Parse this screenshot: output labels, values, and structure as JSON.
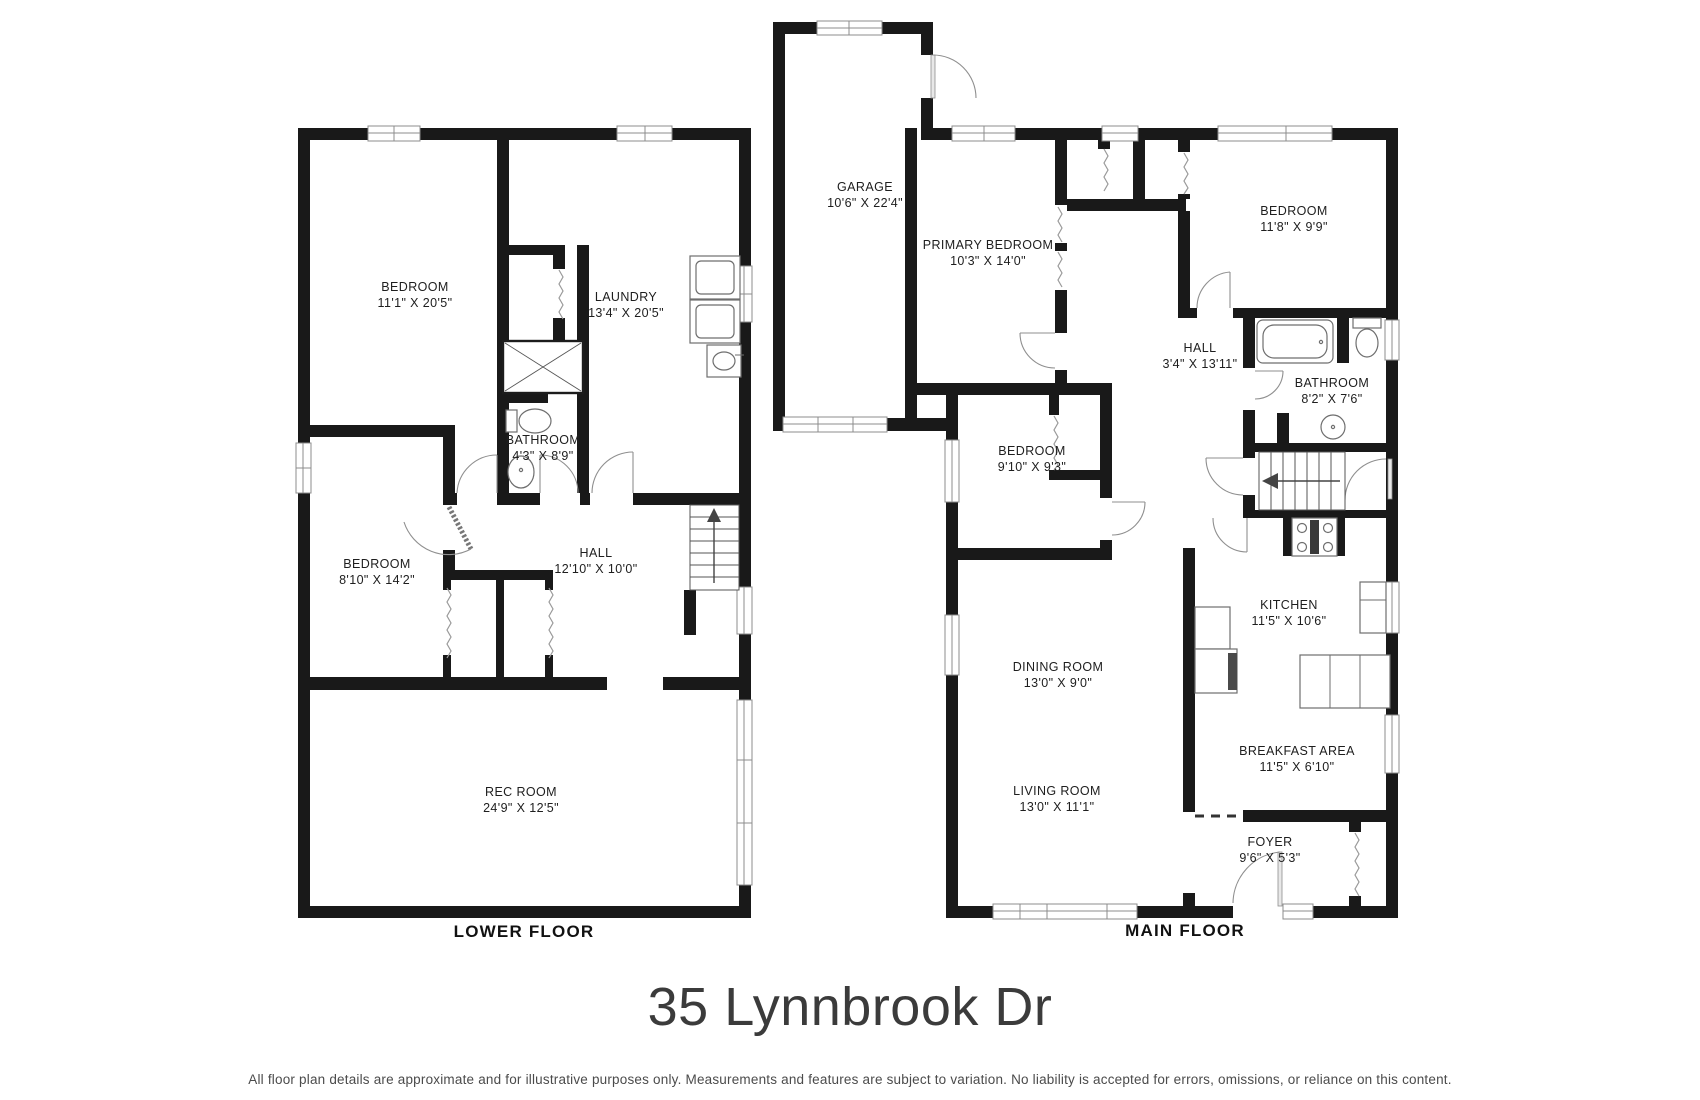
{
  "title": "35 Lynnbrook Dr",
  "disclaimer": "All floor plan details are approximate and for illustrative purposes only. Measurements and features are subject to variation. No liability is accepted for errors, omissions, or reliance on this content.",
  "colors": {
    "wall": "#191919",
    "text": "#1e1e1e",
    "title": "#3b3b3b",
    "line_gray": "#8f8f8f"
  },
  "floors": {
    "lower": {
      "label": "LOWER FLOOR",
      "rooms": [
        {
          "name": "BEDROOM",
          "dims": "11'1\" X  20'5\""
        },
        {
          "name": "LAUNDRY",
          "dims": "13'4\" X  20'5\""
        },
        {
          "name": "BATHROOM",
          "dims": "4'3\" X  8'9\""
        },
        {
          "name": "BEDROOM",
          "dims": "8'10\" X  14'2\""
        },
        {
          "name": "HALL",
          "dims": "12'10\" X  10'0\""
        },
        {
          "name": "REC ROOM",
          "dims": "24'9\" X  12'5\""
        }
      ]
    },
    "main": {
      "label": "MAIN FLOOR",
      "rooms": [
        {
          "name": "GARAGE",
          "dims": "10'6\" X 22'4\""
        },
        {
          "name": "PRIMARY BEDROOM",
          "dims": "10'3\" X 14'0\""
        },
        {
          "name": "BEDROOM",
          "dims": "11'8\" X  9'9\""
        },
        {
          "name": "HALL",
          "dims": "3'4\" X 13'11\""
        },
        {
          "name": "BATHROOM",
          "dims": "8'2\" X 7'6\""
        },
        {
          "name": "BEDROOM",
          "dims": "9'10\" X 9'3\""
        },
        {
          "name": "KITCHEN",
          "dims": "11'5\" X 10'6\""
        },
        {
          "name": "DINING ROOM",
          "dims": "13'0\" X 9'0\""
        },
        {
          "name": "LIVING ROOM",
          "dims": "13'0\" X 11'1\""
        },
        {
          "name": "BREAKFAST AREA",
          "dims": "11'5\" X 6'10\""
        },
        {
          "name": "FOYER",
          "dims": "9'6\" X 5'3\""
        }
      ]
    }
  }
}
